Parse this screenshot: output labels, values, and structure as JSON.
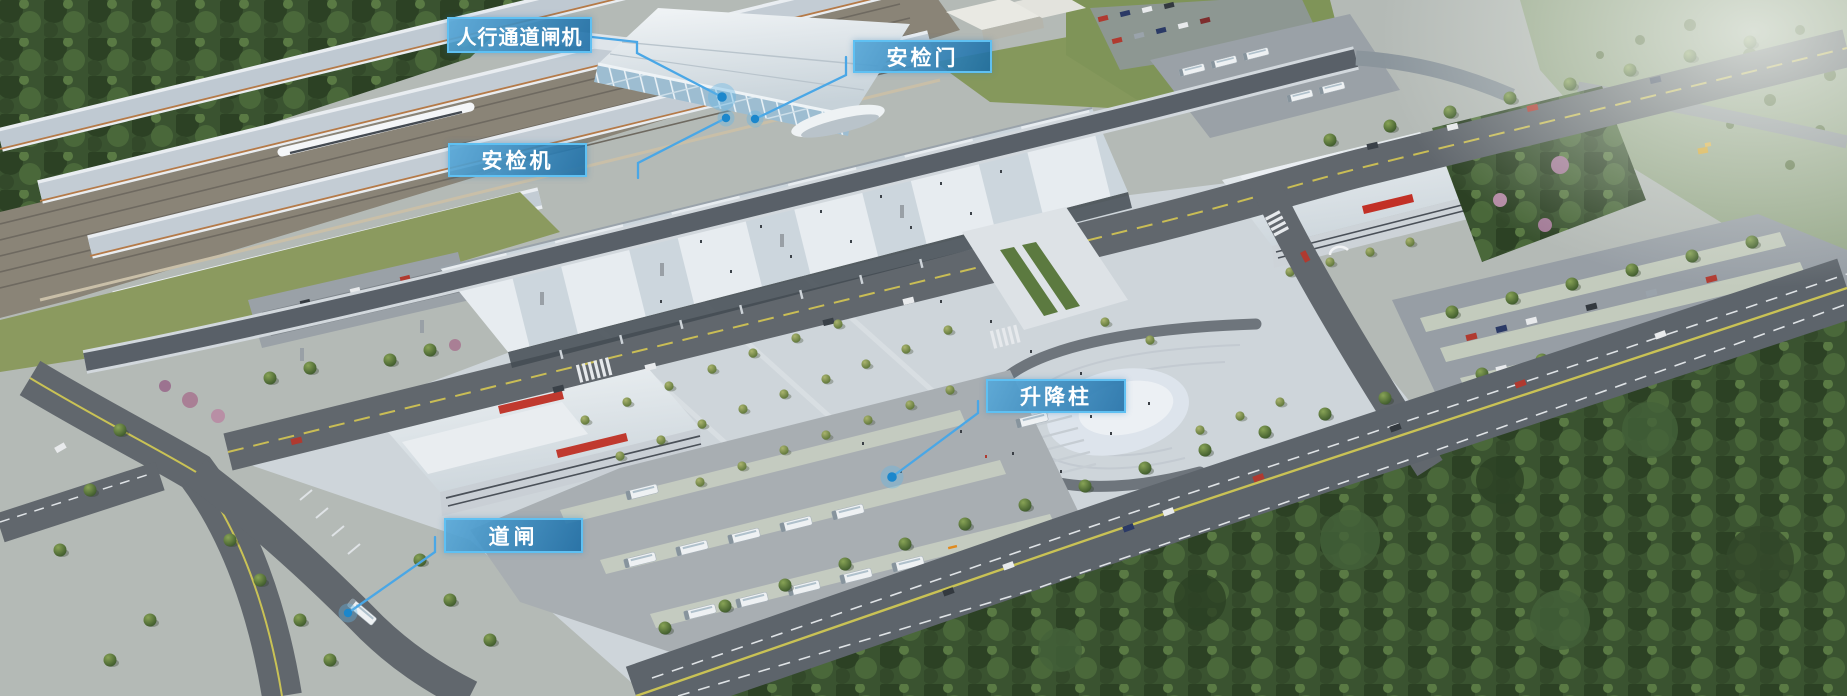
{
  "callouts": [
    {
      "id": "pedestrian-channel-gate",
      "label": "人行通道闸机"
    },
    {
      "id": "security-door",
      "label": "安检门"
    },
    {
      "id": "security-scanner",
      "label": "安检机"
    },
    {
      "id": "lifting-bollard",
      "label": "升降柱"
    },
    {
      "id": "road-barrier-gate",
      "label": "道闸"
    }
  ],
  "style": {
    "label_fill": "#247EB7",
    "label_border": "#5FC0F2",
    "leader_line": "#4AA7E6",
    "marker_dot": "#1B87CC",
    "marker_halo": "#64B5E6"
  }
}
